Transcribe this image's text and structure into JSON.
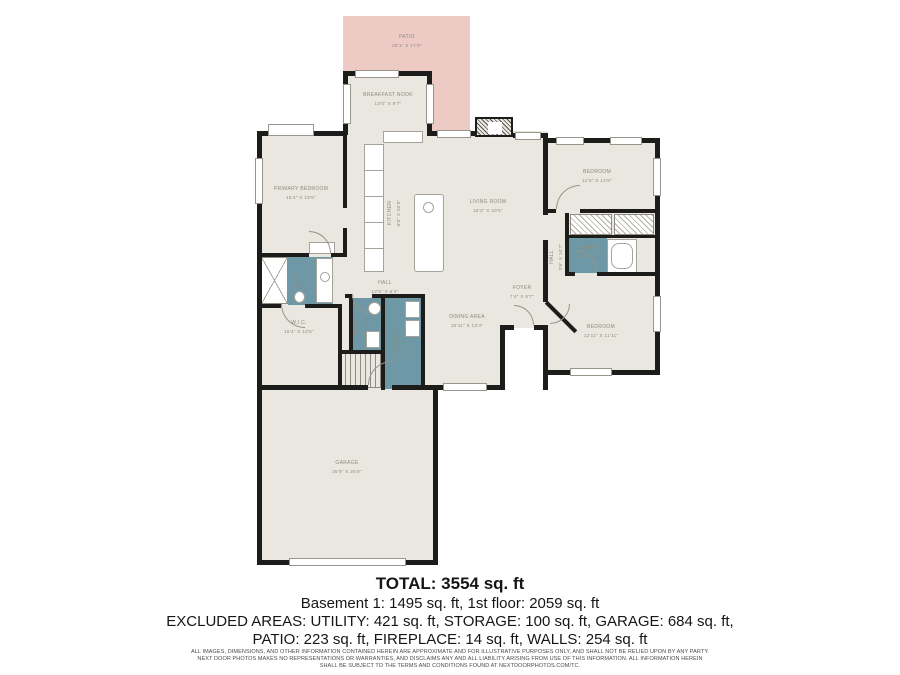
{
  "colors": {
    "wall": "#1c1c1a",
    "floor": "#e9e7df",
    "patio": "#eecac5",
    "wet_room": "#6e98a6",
    "label_text": "#8e8c7e"
  },
  "rooms": [
    {
      "name": "PATIO",
      "dims": "20'1\" X 17'8\""
    },
    {
      "name": "BREAKFAST NOOK",
      "dims": "13'0\" X 9'7\""
    },
    {
      "name": "PRIMARY BEDROOM",
      "dims": "15'4\" X 19'5\""
    },
    {
      "name": "KITCHEN",
      "dims": "8'8\" X 20'9\""
    },
    {
      "name": "LIVING ROOM",
      "dims": "18'3\" X 20'5\""
    },
    {
      "name": "BEDROOM",
      "dims": "12'8\" X 14'8\""
    },
    {
      "name": "BATH",
      "dims": "9'2\" X 5'7\""
    },
    {
      "name": "HALL",
      "dims": "3'6\" X 10'7\""
    },
    {
      "name": "HALL",
      "dims": "12'5\" X 6'4\""
    },
    {
      "name": "BATH",
      "dims": "8'9\" X 7'0\""
    },
    {
      "name": "W.I.C.",
      "dims": "15'4\" X 10'5\""
    },
    {
      "name": "BATH",
      "dims": "3'4\" X 6'2\""
    },
    {
      "name": "LAUNDRY",
      "dims": "5'9\" X 10'9\""
    },
    {
      "name": "DINING AREA",
      "dims": "10'11\" X 13'4\""
    },
    {
      "name": "FOYER",
      "dims": "7'4\" X 9'7\""
    },
    {
      "name": "BEDROOM",
      "dims": "12'11\" X 11'11\""
    },
    {
      "name": "GARAGE",
      "dims": "25'9\" X 25'9\""
    }
  ],
  "summary": {
    "total": "TOTAL: 3554 sq. ft",
    "floors": "Basement 1: 1495 sq. ft, 1st floor: 2059 sq. ft",
    "excluded_1": "EXCLUDED AREAS: UTILITY: 421 sq. ft, STORAGE: 100 sq. ft, GARAGE: 684 sq. ft,",
    "excluded_2": "PATIO: 223 sq. ft, FIREPLACE: 14 sq. ft, WALLS: 254 sq. ft"
  },
  "disclaimer": {
    "line1": "ALL IMAGES, DIMENSIONS, AND OTHER INFORMATION CONTAINED HEREIN ARE APPROXIMATE AND FOR ILLUSTRATIVE PURPOSES ONLY, AND SHALL NOT BE RELIED UPON BY ANY PARTY.",
    "line2": "NEXT DOOR PHOTOS MAKES NO REPRESENTATIONS OR WARRANTIES, AND DISCLAIMS ANY AND ALL LIABILITY ARISING FROM USE OF THIS INFORMATION. ALL INFORMATION HEREIN",
    "line3": "SHALL BE SUBJECT TO THE TERMS AND CONDITIONS FOUND AT NEXTDOORPHOTOS.COM/TC."
  }
}
